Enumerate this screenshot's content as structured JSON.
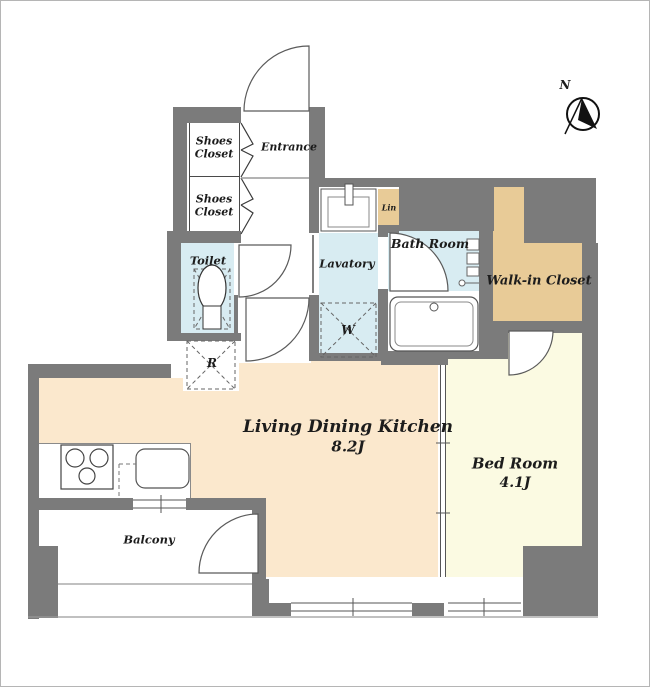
{
  "palette": {
    "wall": "#7b7b7b",
    "wet_room_blue": "#d8ecf2",
    "closet_tan": "#e8cb97",
    "ldk_peach": "#fbe8cd",
    "bedroom_yellow": "#fbfae2",
    "floor_white": "#ffffff",
    "line": "#555555"
  },
  "rooms": {
    "entrance": {
      "label": "Entrance"
    },
    "shoes_closet_upper": {
      "line1": "Shoes",
      "line2": "Closet"
    },
    "shoes_closet_lower": {
      "line1": "Shoes",
      "line2": "Closet"
    },
    "toilet": {
      "label": "Toilet"
    },
    "lavatory": {
      "label": "Lavatory"
    },
    "bath": {
      "label": "Bath Room"
    },
    "linen": {
      "label": "Lin"
    },
    "walk_in_closet": {
      "label": "Walk-in Closet"
    },
    "ldk": {
      "label": "Living Dining Kitchen",
      "size": "8.2J"
    },
    "bedroom": {
      "label": "Bed Room",
      "size": "4.1J"
    },
    "balcony": {
      "label": "Balcony"
    }
  },
  "fixtures": {
    "washer": "W",
    "refrigerator": "R"
  },
  "compass": {
    "north": "N"
  }
}
